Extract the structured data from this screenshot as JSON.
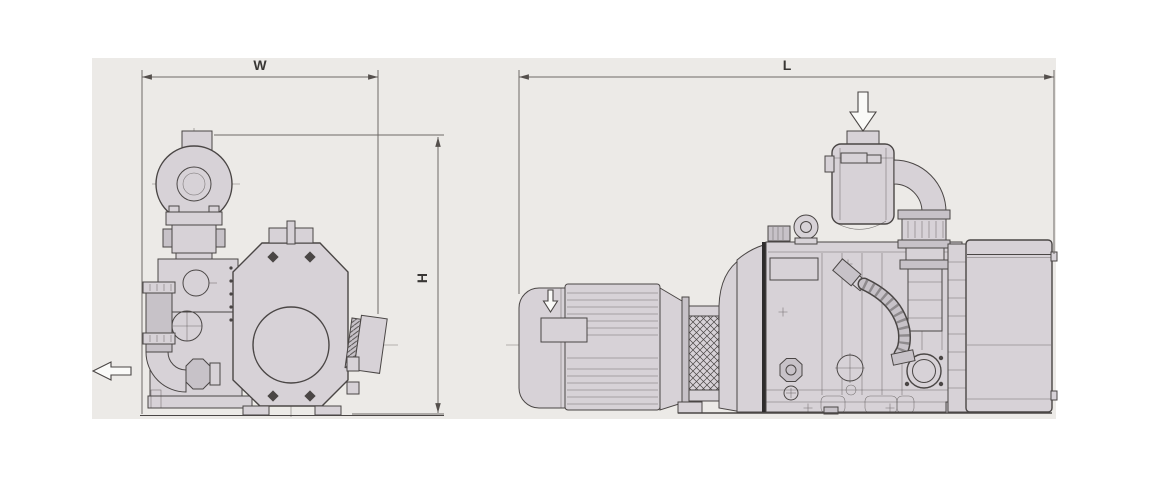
{
  "drawing": {
    "kind": "pump-dimensional-outline-drawing"
  },
  "dimensions": {
    "width_label": "W",
    "height_label": "H",
    "length_label": "L"
  },
  "icons": {
    "exhaust_flow_arrow": "hollow-left-arrow",
    "inlet_flow_arrow": "hollow-down-arrow",
    "motor_airflow_arrow": "hollow-down-arrow"
  },
  "colors": {
    "canvas_bg": "#ffffff",
    "panel_bg": "#eceae7",
    "part_fill": "#d7d2d7",
    "part_shade": "#c7c2c8",
    "line": "#4a4645",
    "seam_dark": "#2e2c2c",
    "dim_line": "#6e6a67",
    "arrow_fill": "#fafaf8"
  }
}
